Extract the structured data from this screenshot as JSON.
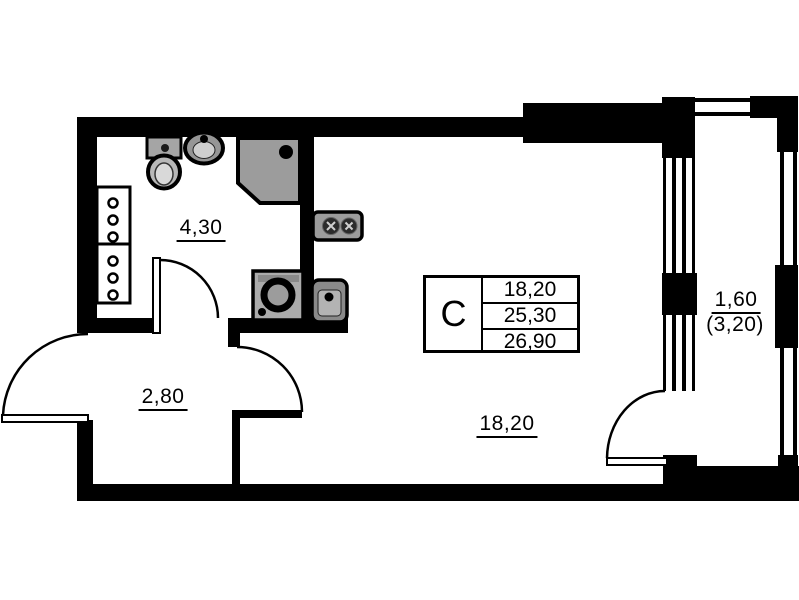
{
  "title": "Studio apartment floor plan",
  "legend": {
    "unit_type": "С",
    "areas": [
      "18,20",
      "25,30",
      "26,90"
    ]
  },
  "labels": {
    "bathroom_area": "4,30",
    "hallway_area": "2,80",
    "main_room_area": "18,20",
    "balcony_area": "1,60",
    "balcony_area_total": "(3,20)"
  },
  "colors": {
    "wall": "#000000",
    "fixture_gray": "#9c9c9c",
    "background": "#ffffff"
  }
}
